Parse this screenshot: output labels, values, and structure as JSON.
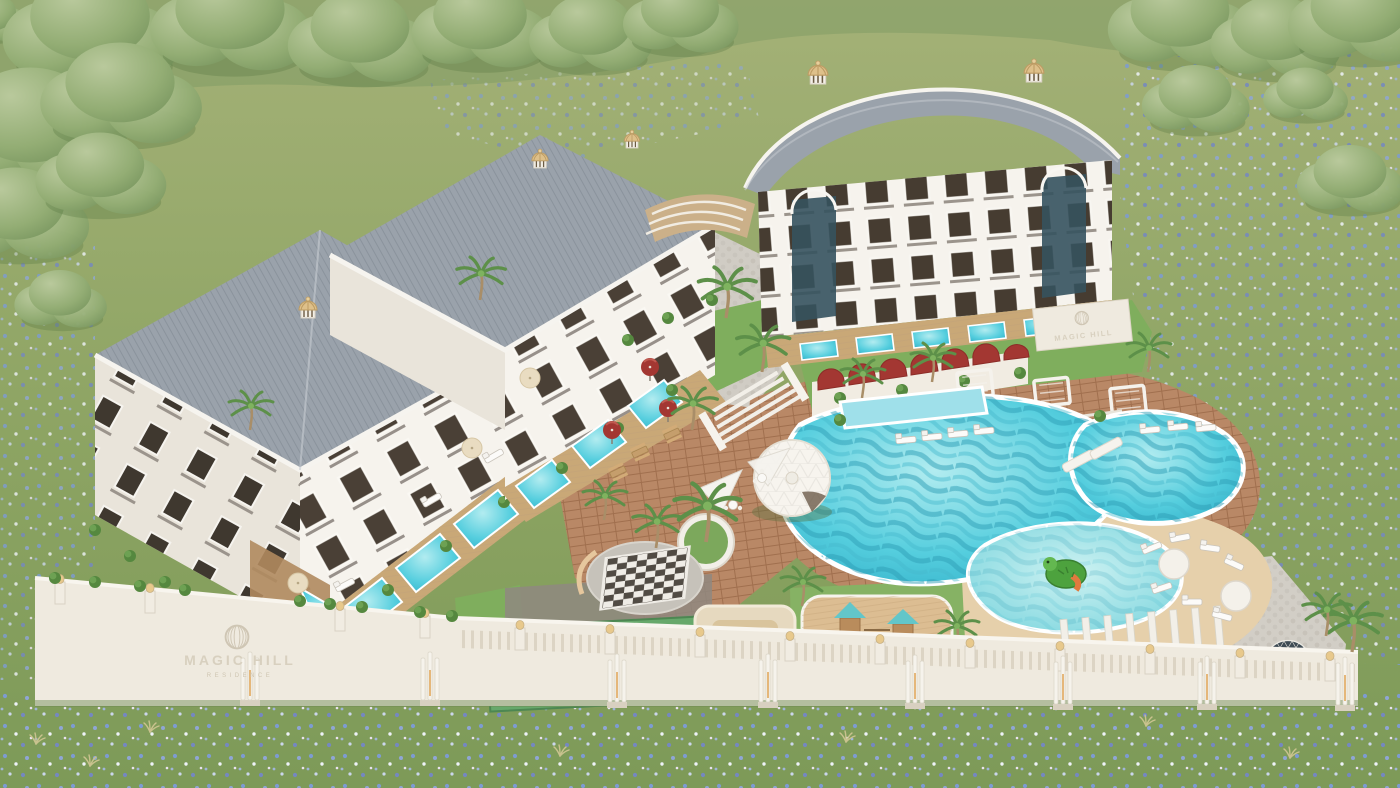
{
  "scene_type": "aerial 3d architectural render of a residential resort complex",
  "branding": {
    "gate_logo": {
      "title": "MAGIC HILL",
      "subtitle": "RESIDENCE",
      "emblem": "ribbed-sphere"
    },
    "inner_logo": {
      "title": "MAGIC HILL",
      "emblem": "ribbed-sphere"
    }
  },
  "palette": {
    "meadow": "#8fa566",
    "forest": "#84a069",
    "facade": "#f4f1ea",
    "roof": "#9aa2ab",
    "pool_water": "#49c3d6",
    "pool_deep": "#2aa9c4",
    "kids_water": "#7fd8de",
    "paver_terracotta": "#b98866",
    "stone_plaza": "#d0ccc4",
    "sun_deck": "#e6d0ab",
    "red_awning": "#a33732",
    "court_blue": "#5c9fc8",
    "court_green": "#67a86b",
    "dome_glass": "#3e4b54",
    "gold_dome": "#dec08a",
    "wall_white": "#efeadf",
    "playground_deck": "#dcbd92",
    "turtle_green": "#4da23e"
  }
}
